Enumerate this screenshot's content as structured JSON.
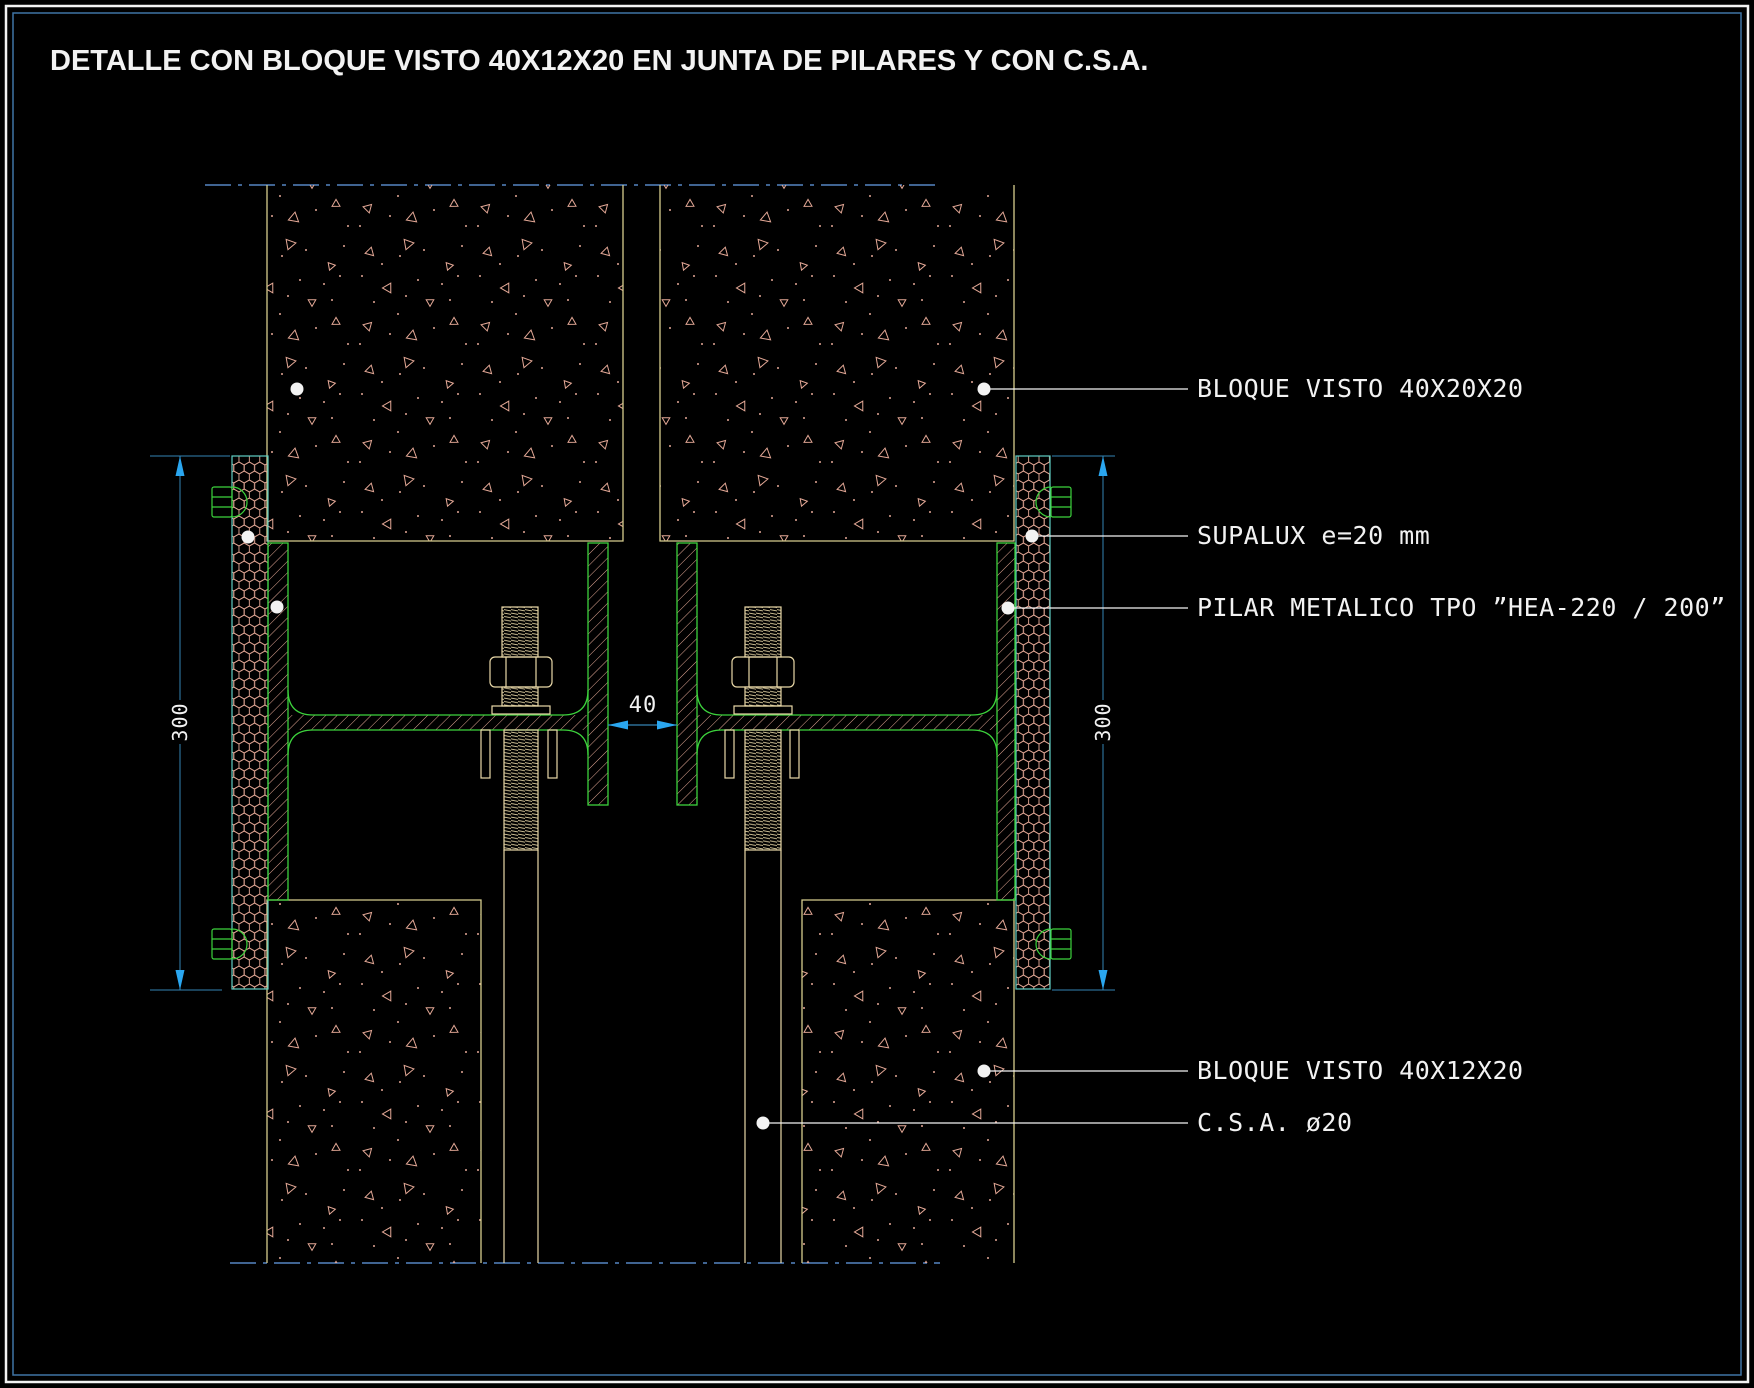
{
  "title": "DETALLE CON BLOQUE VISTO 40X12X20 EN JUNTA DE PILARES Y CON C.S.A.",
  "annotations": {
    "bloque_visto_top": "BLOQUE VISTO 40X20X20",
    "supalux": "SUPALUX e=20 mm",
    "pilar": "PILAR METALICO TPO ”HEA-220 / 200”",
    "bloque_visto_bottom": "BLOQUE VISTO 40X12X20",
    "csa": "C.S.A. ø20"
  },
  "dimensions": {
    "left_height": "300",
    "right_height": "300",
    "joint_gap": "40"
  },
  "palette": {
    "background": "#000000",
    "text_white": "#f2f2f2",
    "block_outline": "#d6cd8e",
    "concrete_stipple": "#e4a896",
    "steel_outline": "#3cd23c",
    "steel_hatch": "#e4a896",
    "supalux_outline": "#5fcfc4",
    "bolt_and_rod": "#ead9a8",
    "dimension_line": "#3584b4",
    "dimension_arrow": "#2aa6ef",
    "centerline": "#5585c2",
    "frame_inner": "#3f74a5",
    "frame_outer": "#f2f2f2"
  }
}
